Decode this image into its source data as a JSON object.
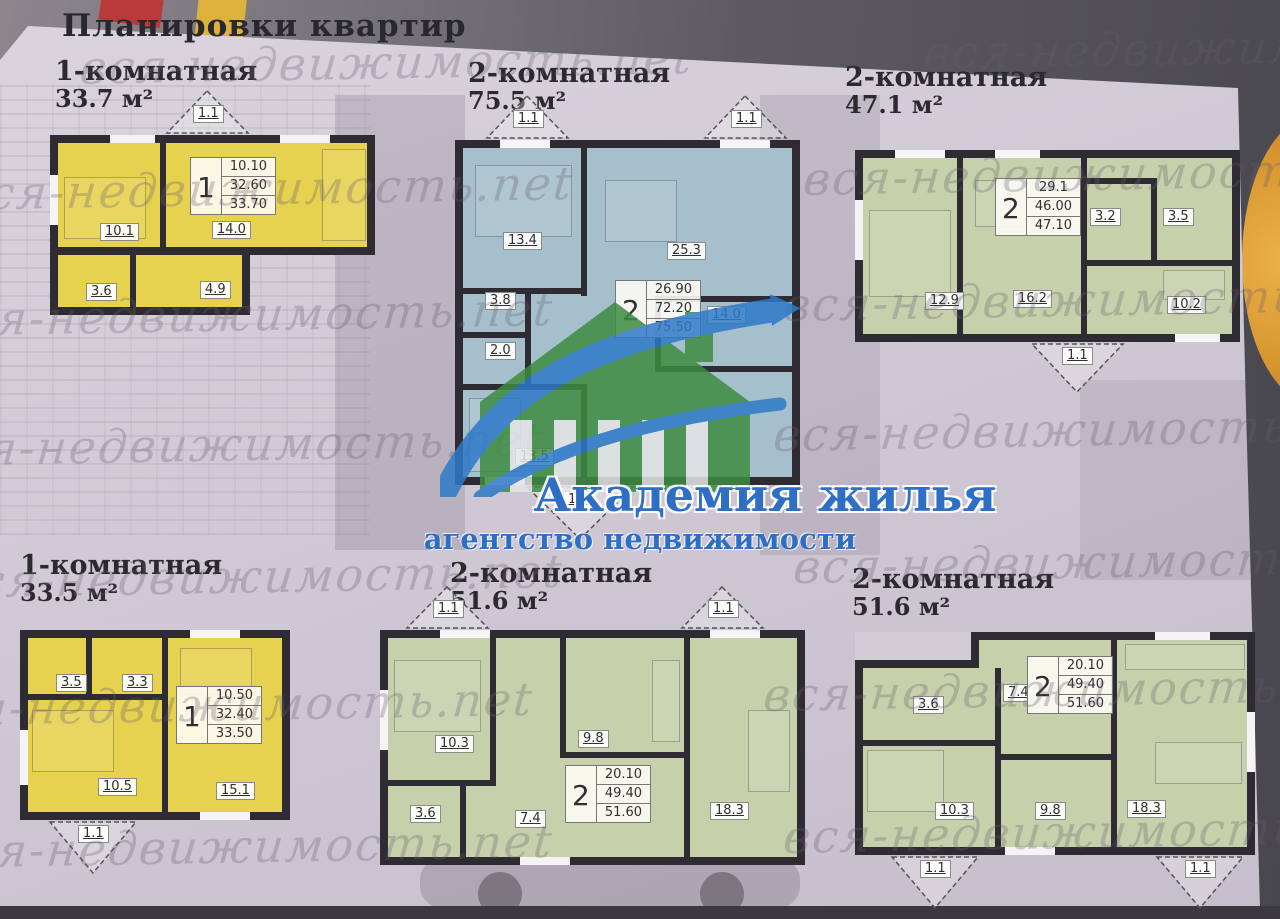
{
  "page": {
    "title": "Планировки квартир",
    "watermark": "вся-недвижимость.net",
    "logo": {
      "title": "Академия жилья",
      "subtitle": "агентство недвижимости"
    },
    "colors": {
      "plan_yellow": "#e6d24e",
      "plan_blue": "#a6bfcc",
      "plan_green": "#c6d1ab",
      "wall": "#2e2c32",
      "logo_green": "#3e8c42",
      "logo_blue": "#2e79c8",
      "logo_text_blue": "#2e6fc5"
    },
    "plans": [
      {
        "type": "1-комнатная",
        "area": "33.7 м²",
        "fill": "#e6d24e",
        "rooms": [
          "10.1",
          "14.0",
          "3.6",
          "4.9"
        ],
        "balconies": [
          "1.1"
        ],
        "info": {
          "count": "1",
          "living": "10.10",
          "area": "32.60",
          "total": "33.70"
        }
      },
      {
        "type": "2-комнатная",
        "area": "75.5 м²",
        "fill": "#a6bfcc",
        "rooms": [
          "13.4",
          "25.3",
          "3.8",
          "2.0",
          "13.5",
          "14.0"
        ],
        "balconies": [
          "1.1",
          "1.1",
          "1.1"
        ],
        "info": {
          "count": "2",
          "living": "26.90",
          "area": "72.20",
          "total": "75.50"
        }
      },
      {
        "type": "2-комнатная",
        "area": "47.1 м²",
        "fill": "#c6d1ab",
        "rooms": [
          "12.9",
          "16.2",
          "3.2",
          "3.5",
          "10.2"
        ],
        "balconies": [
          "1.1"
        ],
        "info": {
          "count": "2",
          "living": "29.1",
          "area": "46.00",
          "total": "47.10"
        }
      },
      {
        "type": "1-комнатная",
        "area": "33.5 м²",
        "fill": "#e6d24e",
        "rooms": [
          "3.5",
          "3.3",
          "10.5",
          "15.1"
        ],
        "balconies": [
          "1.1"
        ],
        "info": {
          "count": "1",
          "living": "10.50",
          "area": "32.40",
          "total": "33.50"
        }
      },
      {
        "type": "2-комнатная",
        "area": "51.6 м²",
        "fill": "#c6d1ab",
        "rooms": [
          "10.3",
          "9.8",
          "3.6",
          "7.4",
          "18.3"
        ],
        "balconies": [
          "1.1",
          "1.1"
        ],
        "info": {
          "count": "2",
          "living": "20.10",
          "area": "49.40",
          "total": "51.60"
        }
      },
      {
        "type": "2-комнатная",
        "area": "51.6 м²",
        "fill": "#c6d1ab",
        "rooms": [
          "3.6",
          "7.4",
          "10.3",
          "9.8",
          "18.3"
        ],
        "balconies": [
          "1.1",
          "1.1"
        ],
        "info": {
          "count": "2",
          "living": "20.10",
          "area": "49.40",
          "total": "51.60"
        }
      }
    ]
  }
}
